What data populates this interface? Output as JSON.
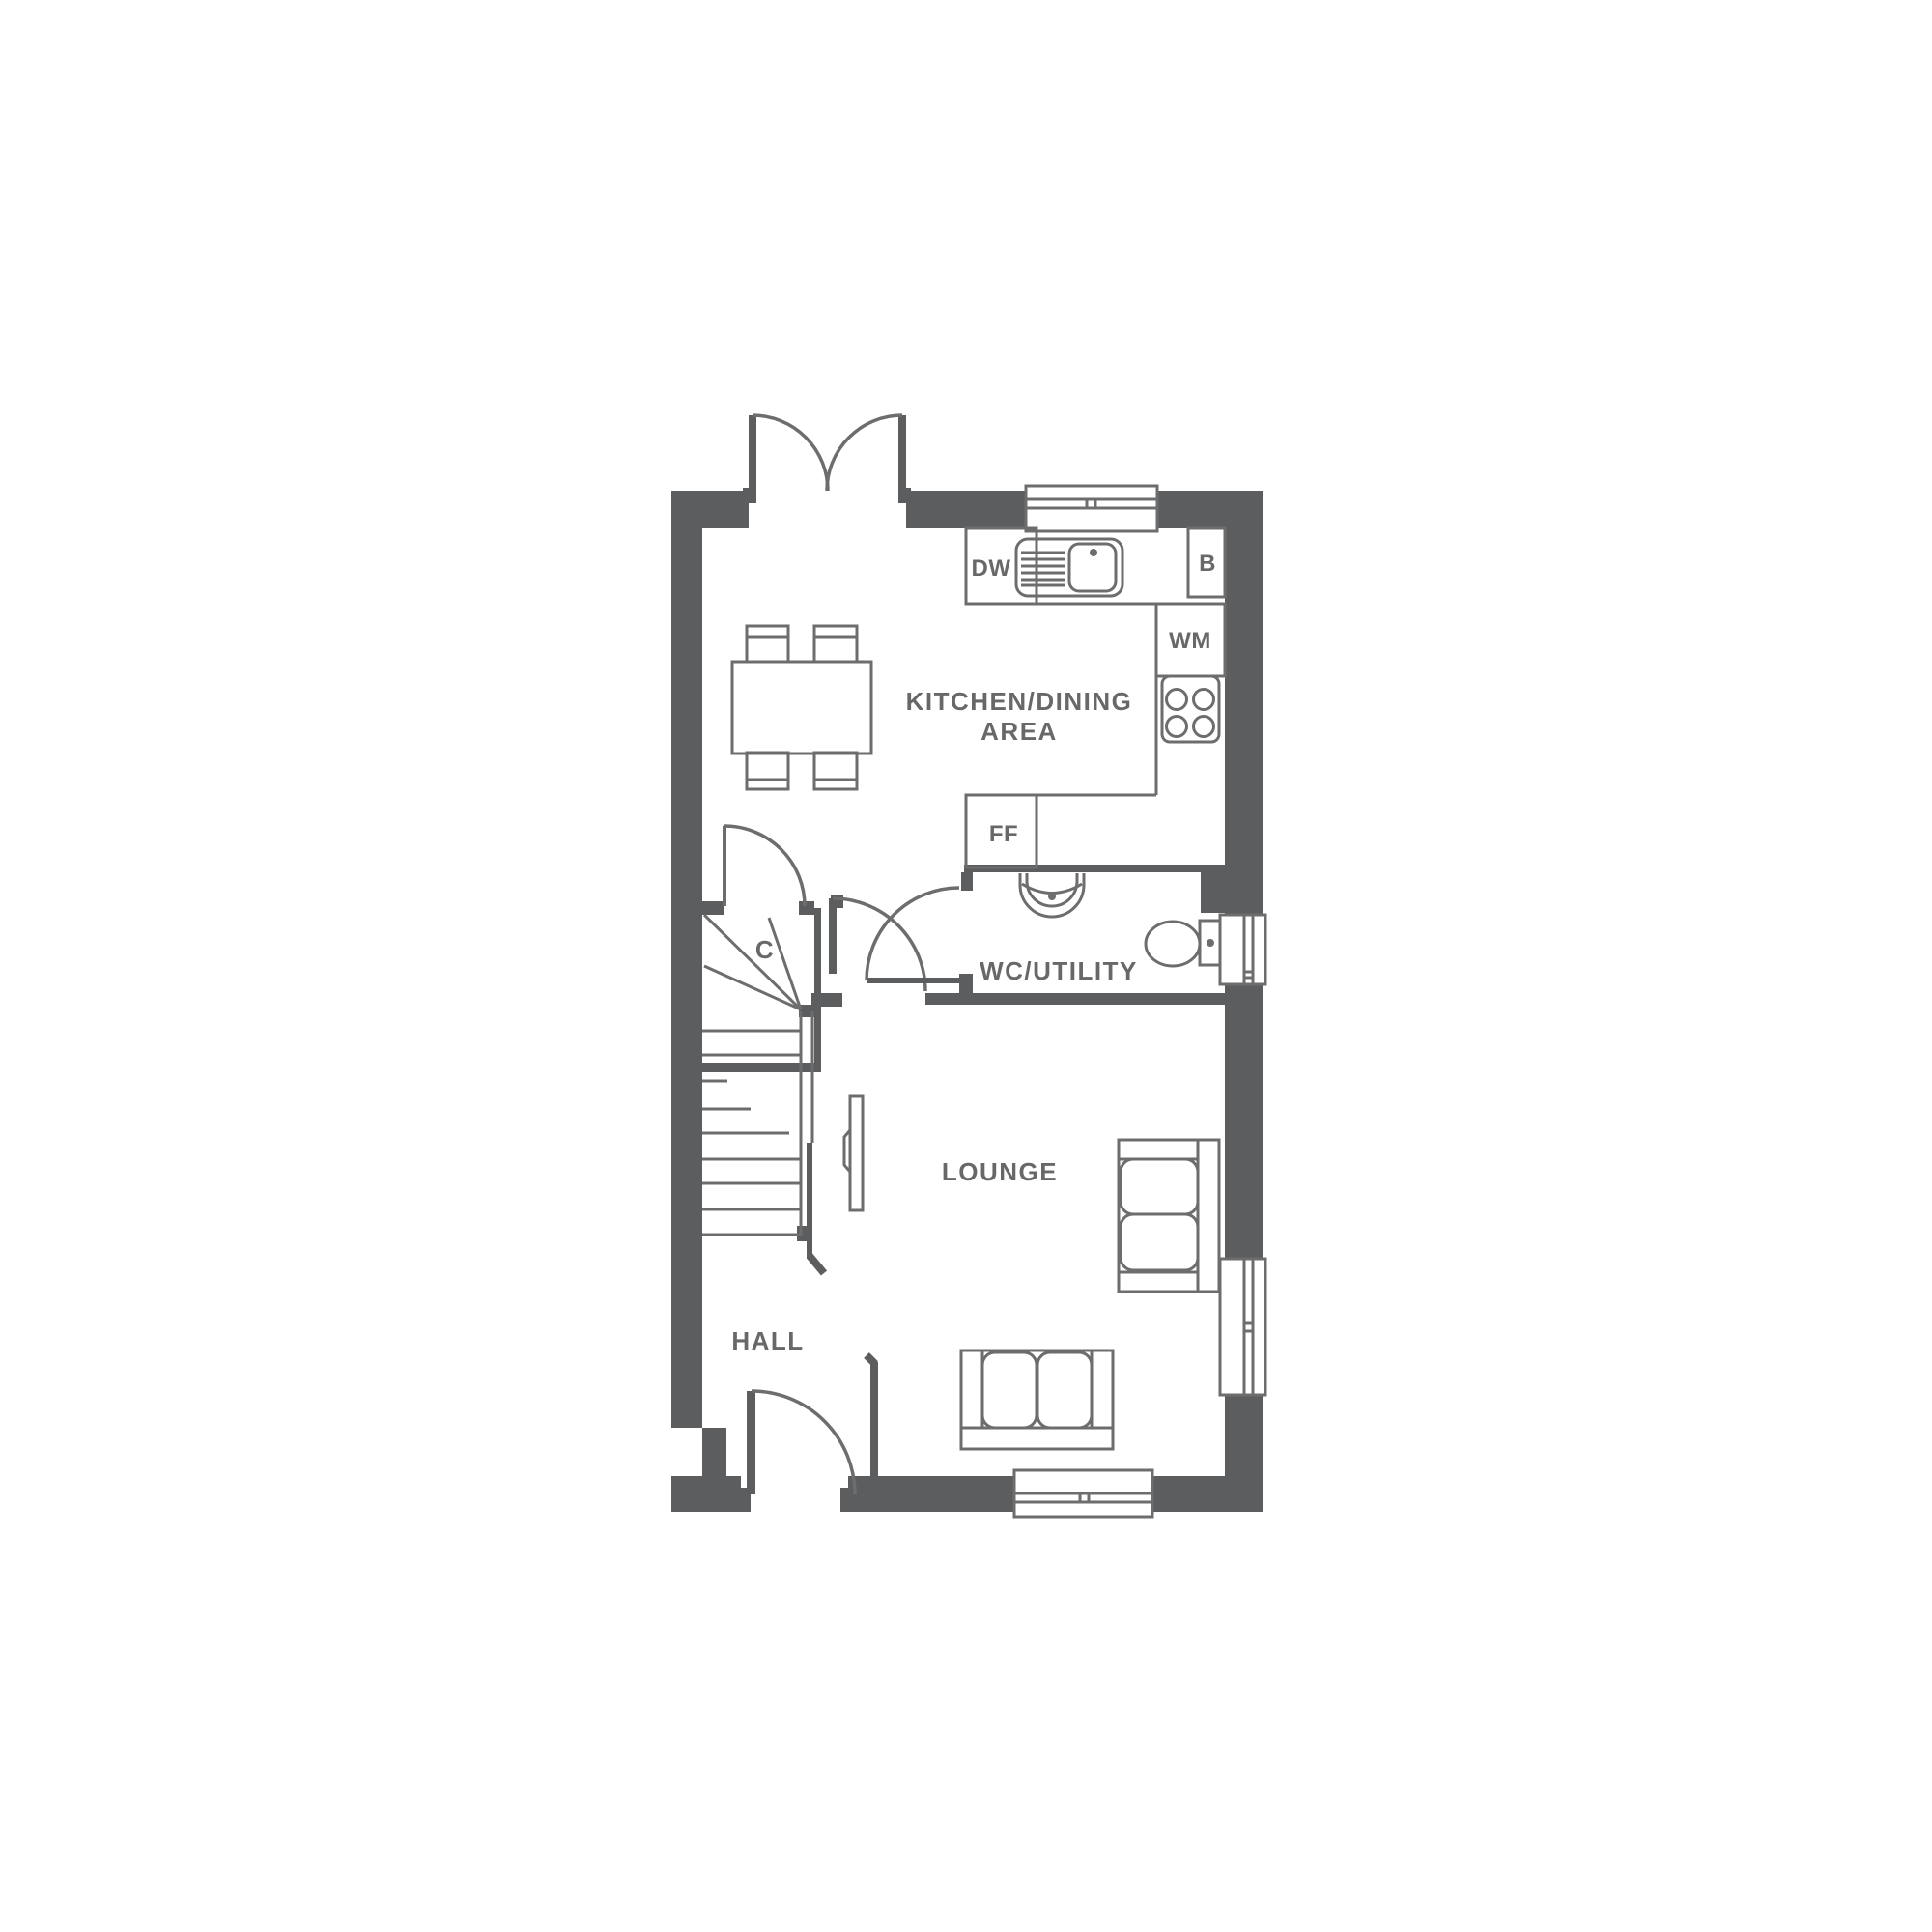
{
  "plan": {
    "title": "Ground floor plan",
    "labels": {
      "kitchen_dining_line1": "KITCHEN/DINING",
      "kitchen_dining_line2": "AREA",
      "wc_utility": "WC/UTILITY",
      "lounge": "LOUNGE",
      "hall": "HALL",
      "cupboard": "C",
      "dishwasher": "DW",
      "boiler": "B",
      "washing_machine": "WM",
      "fridge_freezer": "FF"
    },
    "colors": {
      "wall": "#5c5d5e",
      "line": "#6d6d6d",
      "text": "#686868",
      "background": "#ffffff"
    }
  }
}
